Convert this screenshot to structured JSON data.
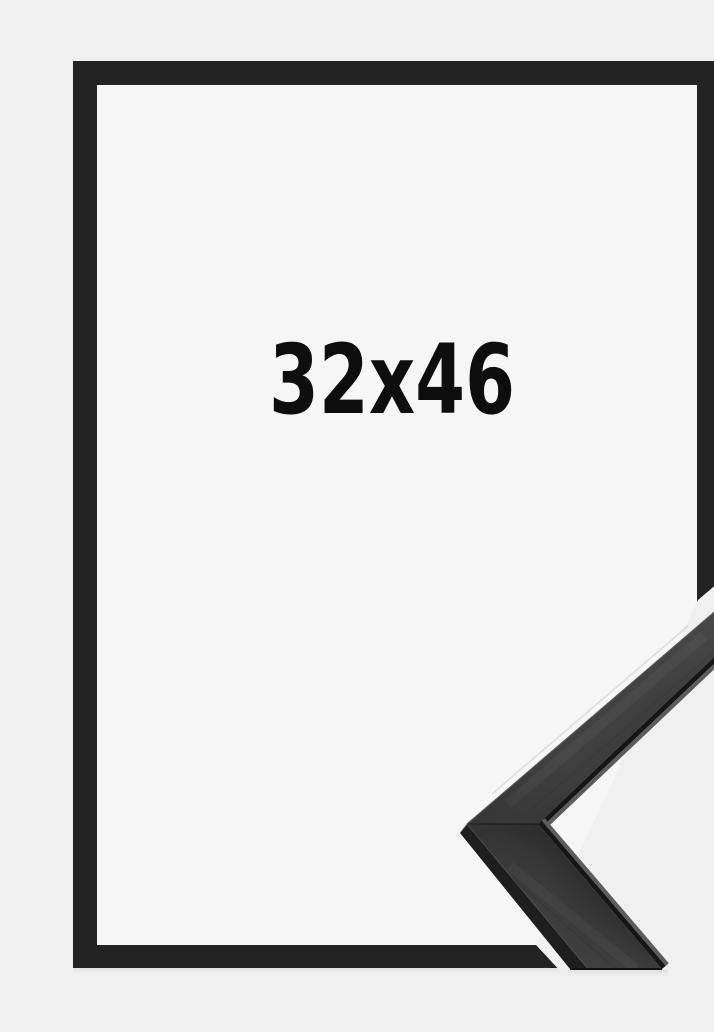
{
  "product_image": {
    "size_label": "32x46",
    "colors": {
      "background": "#f0f0f1",
      "frame_opening": "#f6f6f7",
      "frame_border": "#232323",
      "moulding_face": "#353535",
      "moulding_side": "#1e1e1e",
      "moulding_lip_dark": "#161616",
      "moulding_lip_light": "#5c5c5c",
      "edge_highlight": "#565656",
      "label_text": "#0e0e0e"
    }
  }
}
